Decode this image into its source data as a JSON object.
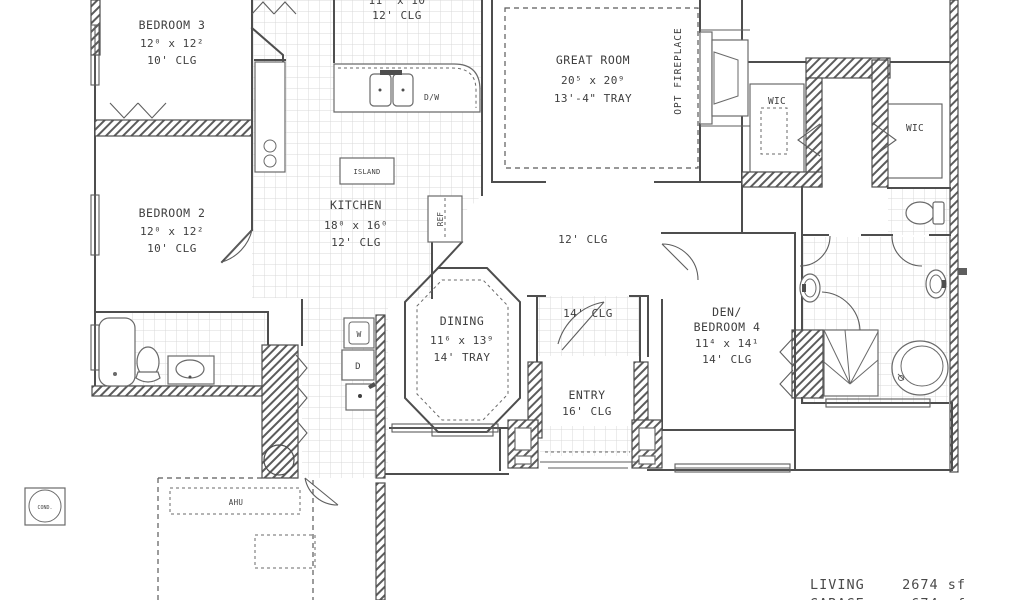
{
  "document": {
    "type": "residential floor plan"
  },
  "rooms": {
    "bedroom3": {
      "name": "BEDROOM 3",
      "dims": "12⁰ x 12²",
      "clg": "10' CLG"
    },
    "bedroom2": {
      "name": "BEDROOM 2",
      "dims": "12⁰ x 12²",
      "clg": "10' CLG"
    },
    "cafe": {
      "dims": "11' x 10",
      "clg": "12' CLG"
    },
    "great_room": {
      "name": "GREAT ROOM",
      "dims": "20⁵ x 20⁹",
      "clg": "13'-4\" TRAY"
    },
    "kitchen": {
      "name": "KITCHEN",
      "dims": "18⁰ x 16⁰",
      "clg": "12' CLG"
    },
    "kitchen_hall": {
      "clg": "12' CLG"
    },
    "dining": {
      "name": "DINING",
      "dims": "11⁶ x 13⁹",
      "clg": "14' TRAY"
    },
    "hall": {
      "clg": "14' CLG"
    },
    "entry": {
      "name": "ENTRY",
      "clg": "16' CLG"
    },
    "den": {
      "name1": "DEN/",
      "name2": "BEDROOM 4",
      "dims": "11⁴ x 14¹",
      "clg": "14' CLG"
    },
    "wic_left": {
      "name": "WIC"
    },
    "wic_right": {
      "name": "WIC"
    }
  },
  "labels": {
    "island": "ISLAND",
    "dishwasher": "D/W",
    "refrigerator": "REF",
    "washer": "W",
    "dryer": "D",
    "air_handler": "AHU",
    "condenser": "COND.",
    "opt_fireplace": "OPT FIREPLACE"
  },
  "summary": {
    "living_label": "LIVING",
    "living_value": "2674 sf",
    "garage_label": "GARAGE",
    "garage_value": "674 sf"
  },
  "colors": {
    "line": "#4e4e4e",
    "tile": "#d8d8d8",
    "background": "#ffffff"
  }
}
